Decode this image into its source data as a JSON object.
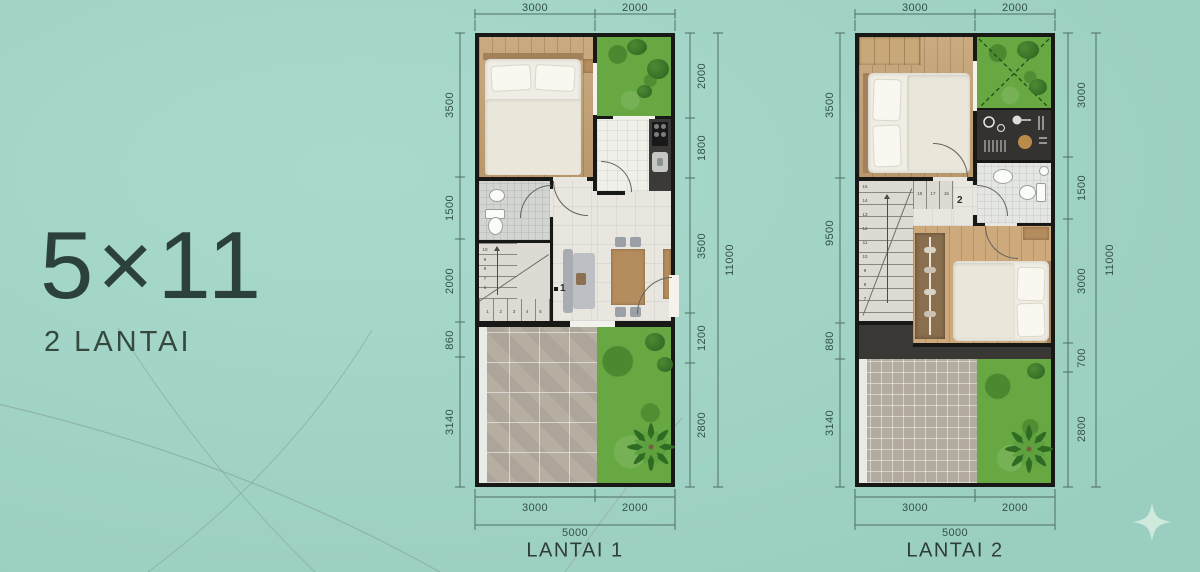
{
  "title": {
    "dimensions": "5×11",
    "floors": "2 LANTAI"
  },
  "plan1": {
    "label": "LANTAI 1",
    "floor_marker": "1",
    "dims_top": [
      "3000",
      "2000"
    ],
    "dims_left": [
      "3500",
      "1500",
      "2000",
      "860",
      "3140"
    ],
    "dims_right": [
      "2000",
      "1800",
      "3500",
      "1200",
      "2800"
    ],
    "dim_right_total": "11000",
    "dims_bottom": [
      "3000",
      "2000"
    ],
    "dim_bottom_total": "5000",
    "stair_steps_run1": [
      "1",
      "2",
      "3",
      "4",
      "5"
    ],
    "stair_steps_run2": [
      "10",
      "9",
      "8",
      "7",
      "6"
    ]
  },
  "plan2": {
    "label": "LANTAI 2",
    "floor_marker": "2",
    "dims_top": [
      "3000",
      "2000"
    ],
    "dims_left": [
      "3500",
      "9500",
      "880",
      "3140"
    ],
    "dims_right": [
      "3000",
      "1500",
      "3000",
      "700",
      "2800"
    ],
    "dim_right_total": "11000",
    "dims_bottom": [
      "3000",
      "2000"
    ],
    "dim_bottom_total": "5000",
    "stair_steps_run1": [
      "15",
      "14",
      "13",
      "12",
      "11",
      "10",
      "9",
      "8",
      "7"
    ],
    "stair_steps_run2": [
      "16",
      "17",
      "18"
    ]
  },
  "colors": {
    "background": "#9fd5c7",
    "wall": "#181816",
    "grass": "#67a843",
    "wood_floor": "#c4a173",
    "tile_floor": "#e8e6df",
    "patio_tile": "#b6aea1",
    "dimension_text": "#33504a",
    "title_text": "#2c413b",
    "sparkle": "#cfeadd"
  }
}
